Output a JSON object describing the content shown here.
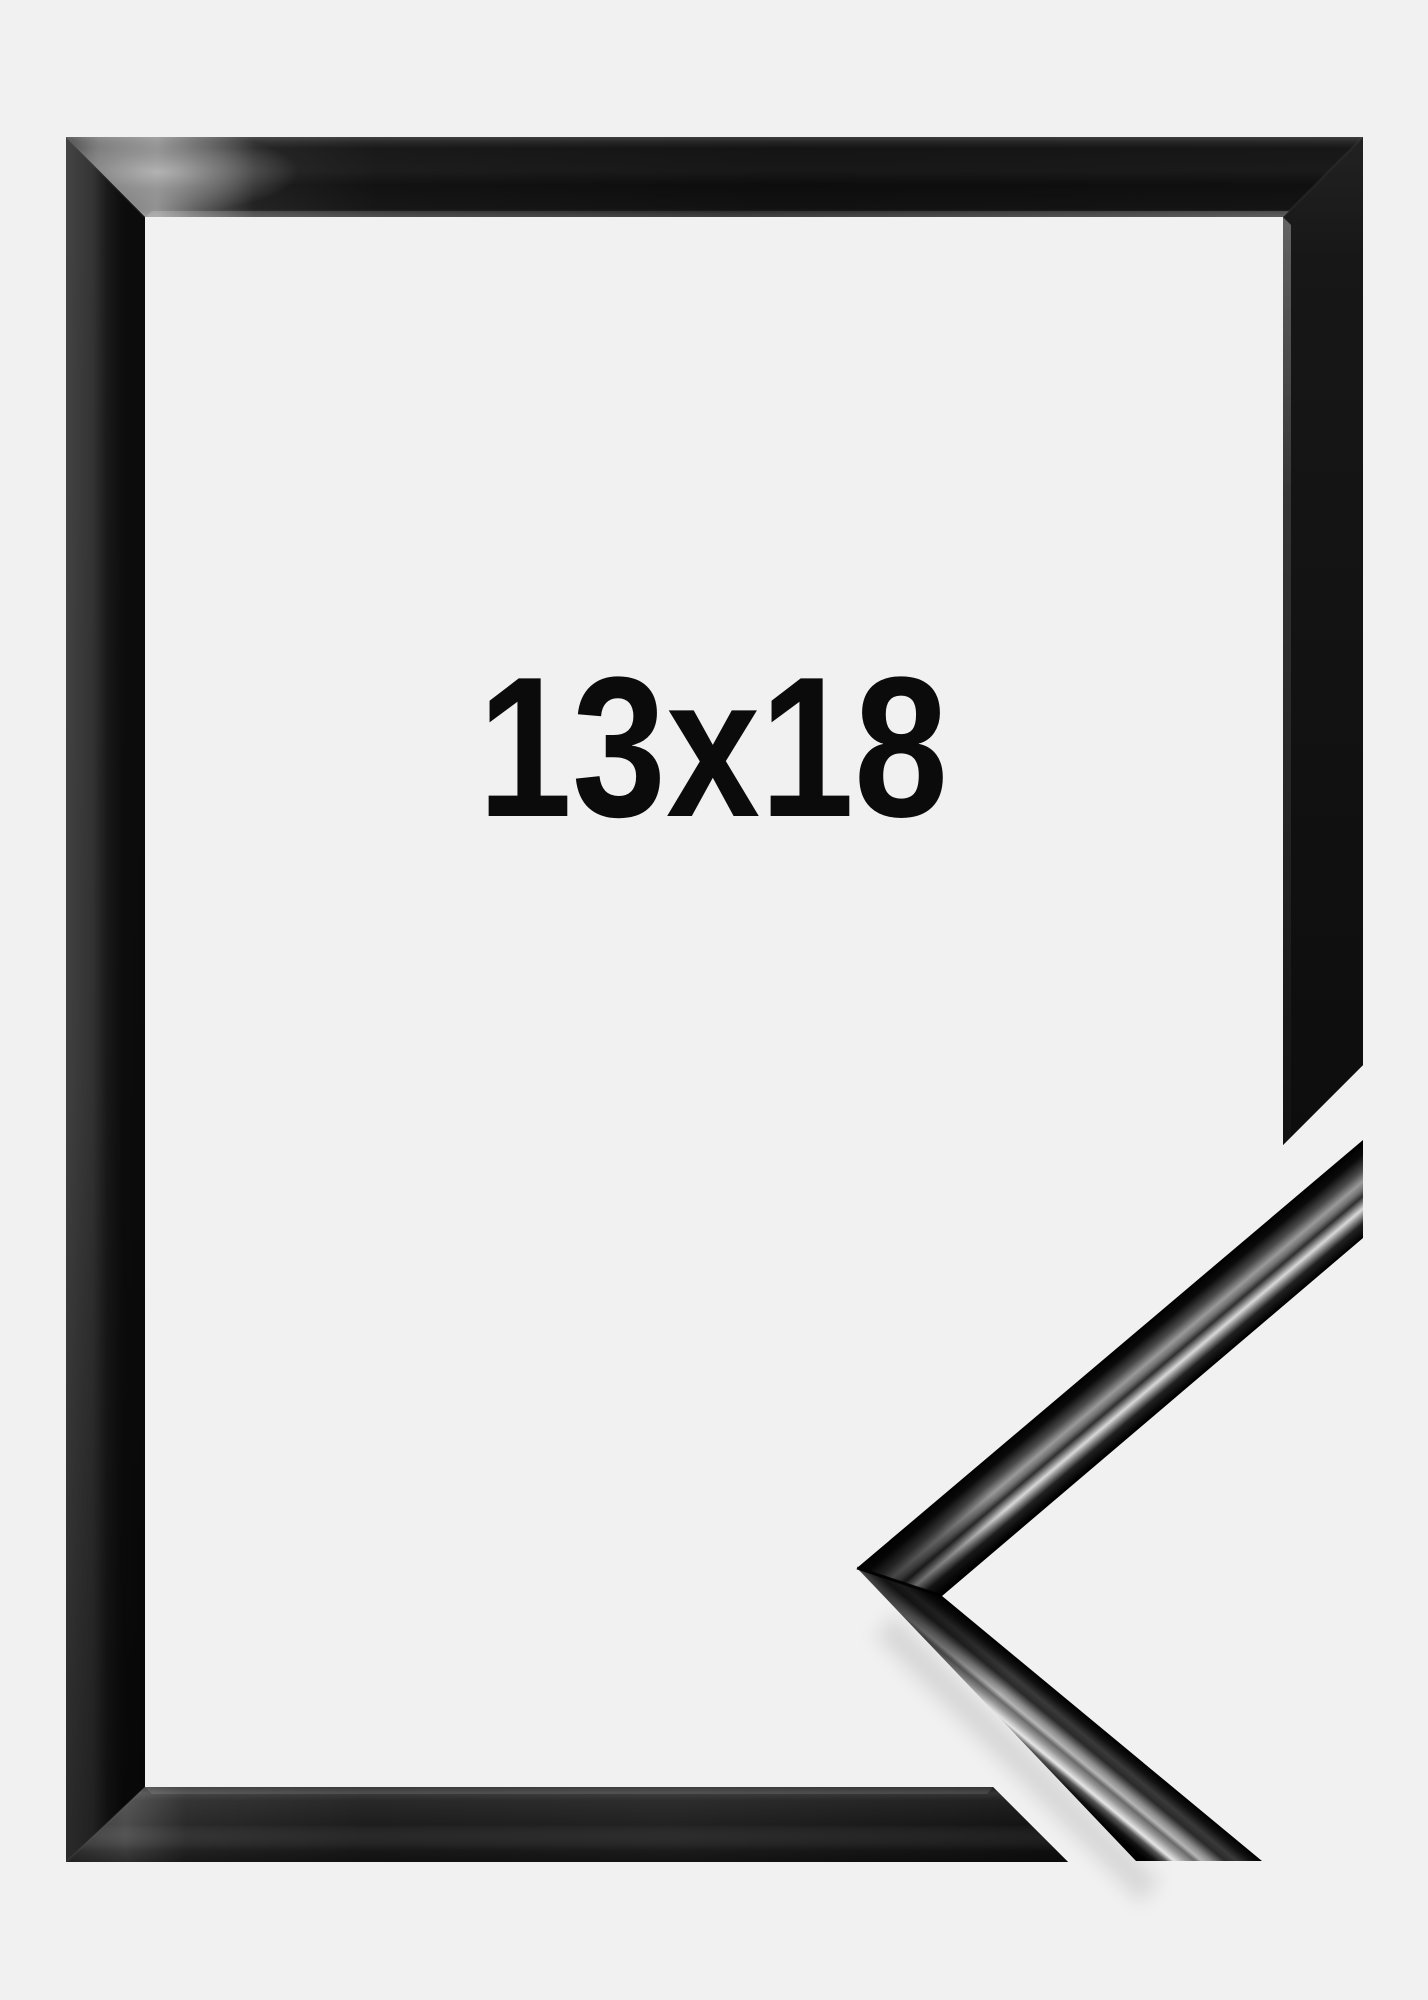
{
  "product_image": {
    "size_label": "13x18",
    "frame_finish": "glossy-black",
    "colors": {
      "background": "#f1f1f2",
      "frame_black": "#0e0e0e",
      "label_text": "#0b0b0b",
      "gloss_highlight": "#d9d9d9"
    }
  }
}
